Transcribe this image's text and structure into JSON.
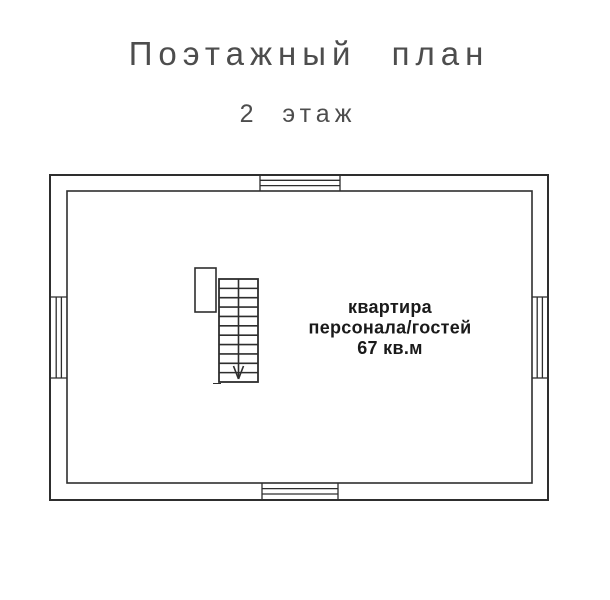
{
  "header": {
    "title": "Поэтажный план",
    "subtitle": "2 этаж"
  },
  "plan": {
    "room": {
      "name_line1": "квартира",
      "name_line2": "персонала/гостей",
      "area": "67 кв.м"
    },
    "stairs": {
      "steps": 11,
      "direction": "down"
    },
    "windows": [
      {
        "side": "top"
      },
      {
        "side": "bottom"
      },
      {
        "side": "left"
      },
      {
        "side": "right"
      }
    ]
  },
  "colors": {
    "background": "#ffffff",
    "wall_line": "#2e2e2e",
    "title_text": "#4d4d4d",
    "room_text": "#1a1a1a"
  }
}
